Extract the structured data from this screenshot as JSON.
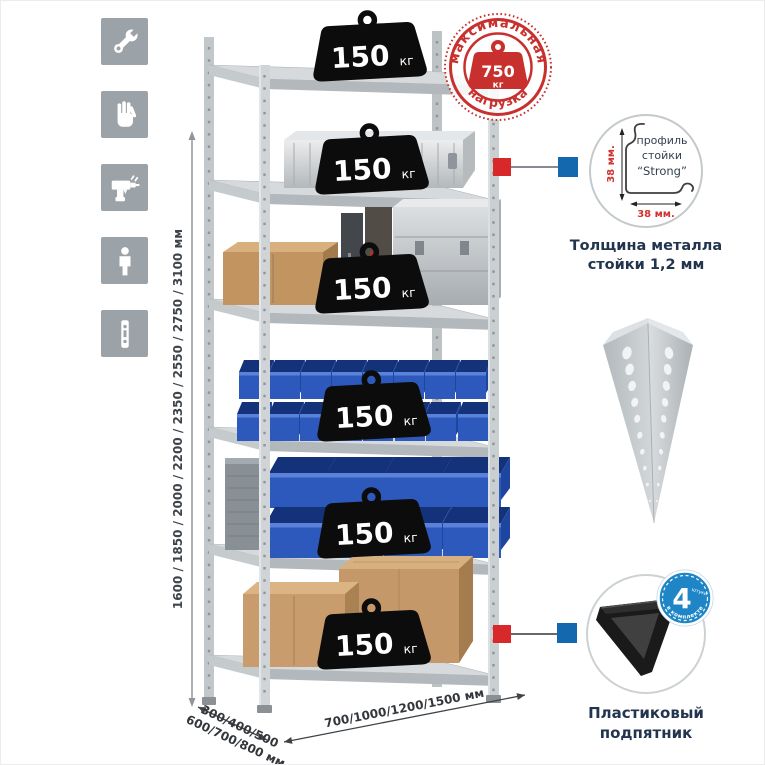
{
  "colors": {
    "accent_red": "#c8302e",
    "accent_blue": "#1468ae",
    "bin_blue": "#2c59bb",
    "icon_gray": "#9ba2a8",
    "text_dark": "#22344e"
  },
  "left_icons": {
    "items": [
      {
        "label": "wrench"
      },
      {
        "label": "gloves"
      },
      {
        "label": "drill"
      },
      {
        "label": "person"
      },
      {
        "label": "upright-profile"
      }
    ]
  },
  "dimensions": {
    "height": "1600 / 1850 / 2000 / 2200 / 2350 / 2550 / 2750 / 3100 мм",
    "depth_line1": "300/400/500",
    "depth_line2": "600/700/800 мм",
    "width": "700/1000/1200/1500 мм"
  },
  "max_load_stamp": {
    "top": "максимальная",
    "bottom": "нагрузка",
    "value": "750",
    "unit": "кг"
  },
  "rack": {
    "shelves": [
      {
        "load": "150",
        "unit": "кг"
      },
      {
        "load": "150",
        "unit": "кг"
      },
      {
        "load": "150",
        "unit": "кг"
      },
      {
        "load": "150",
        "unit": "кг"
      },
      {
        "load": "150",
        "unit": "кг"
      },
      {
        "load": "150",
        "unit": "кг"
      }
    ]
  },
  "profile_detail": {
    "label_line1": "профиль",
    "label_line2": "стойки",
    "label_line3": "“Strong”",
    "dim_v": "38 мм.",
    "dim_h": "38 мм.",
    "caption_line1": "Толщина металла",
    "caption_line2": "стойки 1,2 мм"
  },
  "foot_detail": {
    "badge_number": "4",
    "badge_word": "штуки",
    "badge_arc": "в комплекте",
    "caption_line1": "Пластиковый",
    "caption_line2": "подпятник"
  }
}
